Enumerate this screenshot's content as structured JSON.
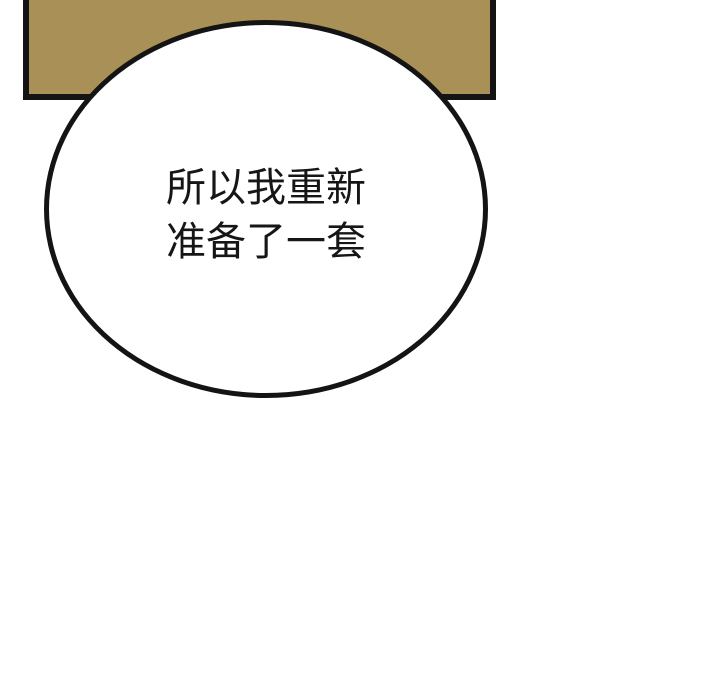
{
  "page": {
    "background_color": "#ffffff"
  },
  "panel": {
    "fill_color": "#a89057",
    "border_color": "#141414"
  },
  "speech_bubble": {
    "fill_color": "#ffffff",
    "border_color": "#141414",
    "text_color": "#161616",
    "lines": [
      "所以我重新",
      "准备了一套"
    ],
    "full_text": "所以我重新准备了一套"
  }
}
